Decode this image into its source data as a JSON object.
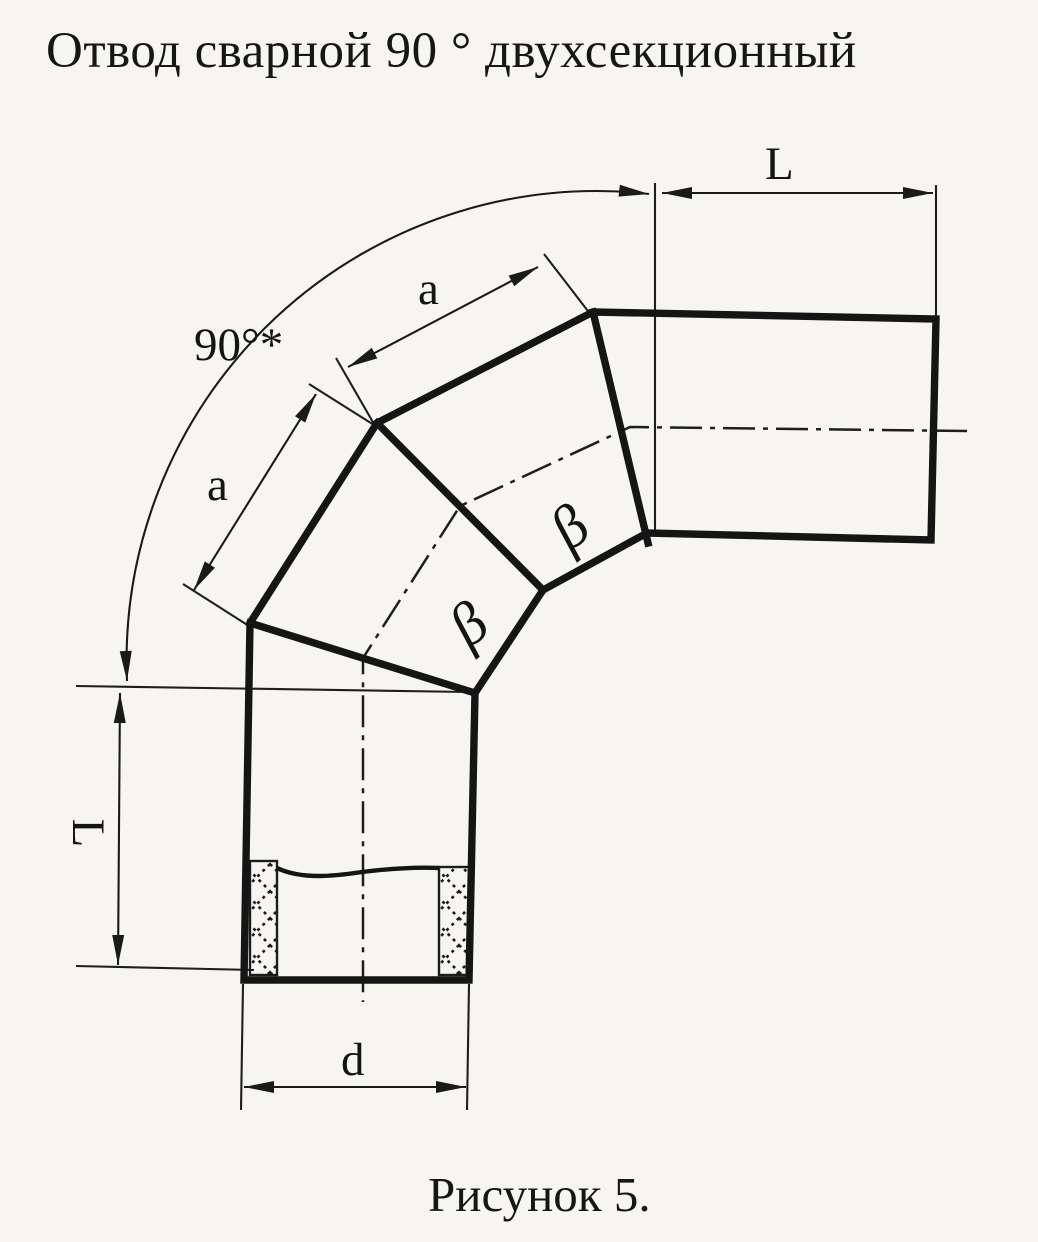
{
  "page": {
    "paper_color": "#f6f5f2",
    "ink_color": "#1a1a1a"
  },
  "title": {
    "text": "Отвод сварной 90 ° двухсекционный"
  },
  "caption": {
    "text": "Рисунок 5."
  },
  "dimensions": {
    "angle_label": "90°*",
    "top_length_label": "L",
    "left_length_label": "L",
    "upper_segment_label": "a",
    "lower_segment_label": "a",
    "diameter_label": "d"
  },
  "annotations": {
    "miter_angle_upper": "β",
    "miter_angle_lower": "β"
  }
}
